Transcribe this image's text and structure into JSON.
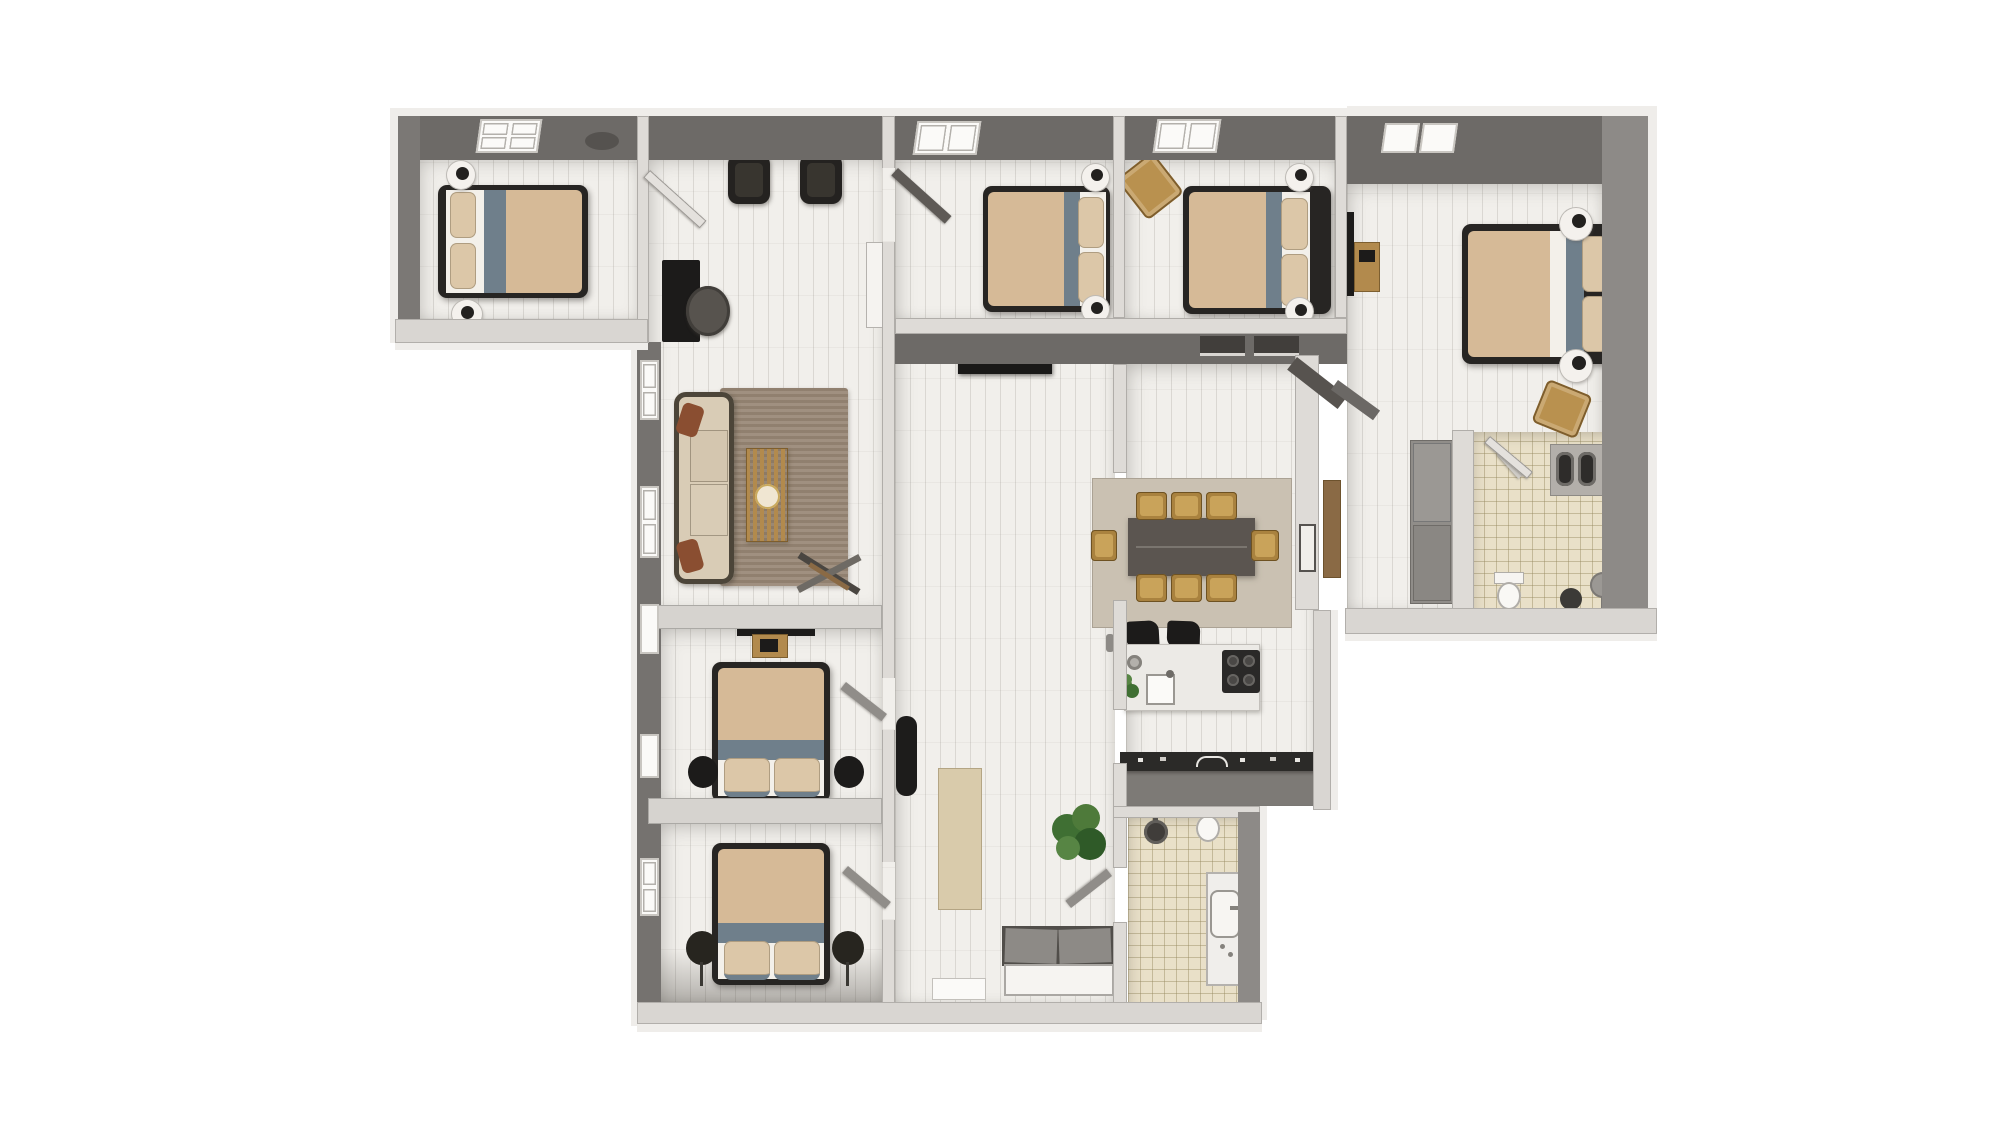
{
  "app": {
    "type": "3d-floor-plan-top-view-render",
    "background": "#ffffff"
  },
  "palette": {
    "floor": "#f1efeb",
    "tile": "#e9e0c8",
    "wall-dark": "#6d6a67",
    "wall-gray": "#8d8a87",
    "wall-light": "#dedbd7",
    "bed-frame": "#272523",
    "blanket": "#d6ba97",
    "bed-band": "#6f7f8b",
    "pillow": "#dcc7a8",
    "sheet": "#f3f0ea",
    "black": "#1c1b1a",
    "wood": "#b28a4d",
    "rug-living": "#998876",
    "rug-dining": "#cac1b2",
    "runner": "#d9cbab",
    "sofa-cushion": "#d9ccb6",
    "sofa-frame": "#4c4539",
    "accent-rust": "#8a4e31",
    "table-dark": "#5b5550",
    "counter-top": "#2b2a28",
    "counter-front": "#7d7a76",
    "plant-green": "#3f6f33"
  },
  "rooms": [
    {
      "id": "bedroom-top-left",
      "label": "bedroom with double bed, skylight and bedside lamps"
    },
    {
      "id": "living-room",
      "label": "living room with sofa, rug, slatted coffee table, two armchairs, desk and chair"
    },
    {
      "id": "bedroom-middle",
      "label": "bedroom with double bed and round nightstands"
    },
    {
      "id": "bedroom-right",
      "label": "bedroom with double bed and rattan chair"
    },
    {
      "id": "master-bedroom",
      "label": "master bedroom with double bed, TV, media console, wardrobe and rattan chair"
    },
    {
      "id": "ensuite-bathroom",
      "label": "ensuite bathroom with double vanity, toilet and stool"
    },
    {
      "id": "dining-room",
      "label": "dining room with eight-seat table on rug"
    },
    {
      "id": "kitchen",
      "label": "kitchen with island, cooktop, bar stools and long counter"
    },
    {
      "id": "hallway",
      "label": "hallway with credenza, runner rug, plant and entry bench"
    },
    {
      "id": "bedroom-bottom-1",
      "label": "bedroom with double bed, wall TV and black stools"
    },
    {
      "id": "bedroom-bottom-2",
      "label": "bedroom with double bed and floor lamps"
    },
    {
      "id": "bathroom",
      "label": "bathroom with walk-in shower, toilet and vanity"
    }
  ]
}
